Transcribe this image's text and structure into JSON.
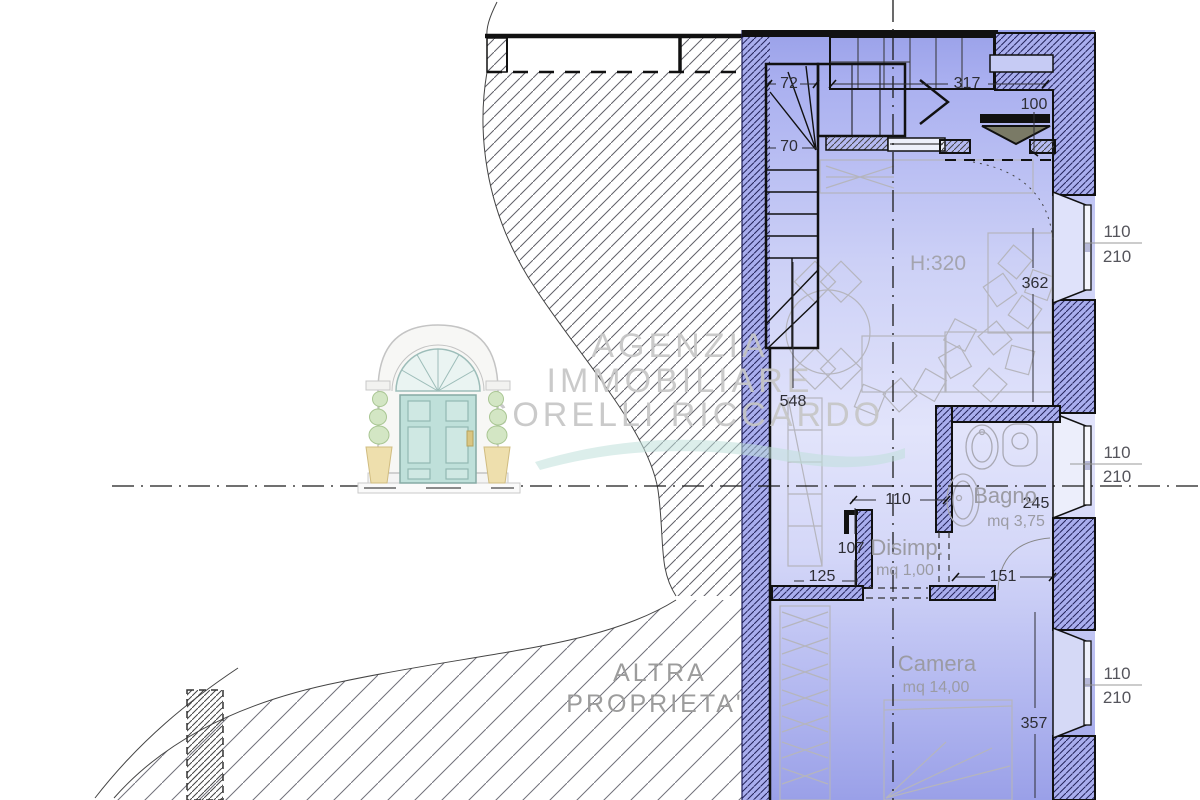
{
  "watermark": {
    "line1": "AGENZIA",
    "line2": "IMMOBILIARE",
    "line3": "GORELLI RICCARDO"
  },
  "neighbor_label": {
    "line1": "ALTRA",
    "line2": "PROPRIETA'"
  },
  "rooms": {
    "living": {
      "height_label": "H:320"
    },
    "bagno": {
      "name": "Bagno",
      "area": "mq 3,75"
    },
    "disimpegno": {
      "name": "Disimp.",
      "area": "mq 1,00"
    },
    "camera": {
      "name": "Camera",
      "area": "mq 14,00"
    }
  },
  "dimensions": {
    "stair_width_top": "72",
    "stair_width_mid": "70",
    "entry_width": "317",
    "entry_depth": "100",
    "living_length": "548",
    "living_east_wall": "362",
    "bagno_width": "245",
    "bagno_door": "151",
    "disimp_door": "110",
    "disimp_depth": "107",
    "hall_width": "125",
    "camera_length": "357"
  },
  "windows": [
    {
      "width": "110",
      "height": "210"
    },
    {
      "width": "110",
      "height": "210"
    },
    {
      "width": "110",
      "height": "210"
    }
  ],
  "colors": {
    "plan_fill": "#c9cdf5",
    "wall_line": "#111111",
    "hatch": "#606068",
    "watermark": "#c6c6c6",
    "logo_door": "#bfe0da",
    "swoosh": "#bfe0da"
  }
}
